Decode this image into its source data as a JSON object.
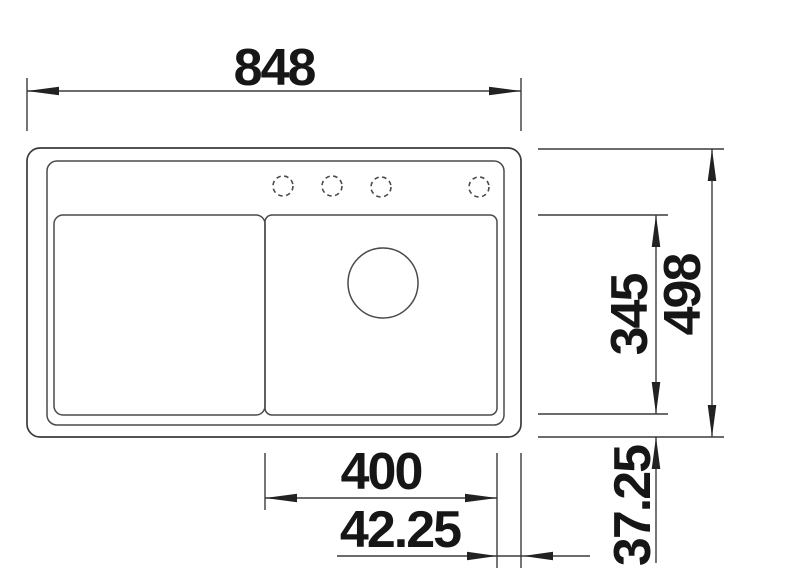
{
  "drawing": {
    "title": "Sink technical drawing – top view",
    "background": "#ffffff",
    "line_color": "#3b3b3b",
    "text_color": "#161616",
    "dimensions": {
      "overall_width": "848",
      "overall_depth": "498",
      "bowl_depth": "345",
      "bowl_width": "400",
      "side_offset": "42.25",
      "bottom_offset": "37.25"
    },
    "features": {
      "tap_holes": 4,
      "drain_holes": 1
    }
  }
}
